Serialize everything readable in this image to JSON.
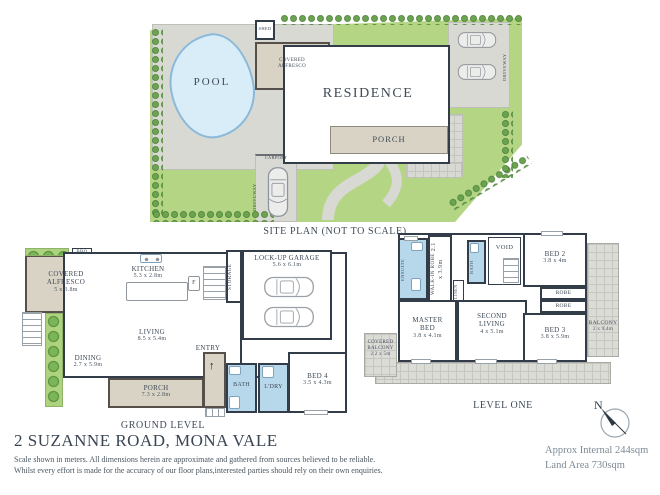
{
  "colors": {
    "wall": "#333d49",
    "wet_room_blue": "#b7d7ea",
    "outdoor_beige": "#d9d3c5",
    "grass_green": "#b3d584",
    "hedge_green": "#4e8538",
    "pool_water": "#d9edf9",
    "paving_grey": "#d9d9d4",
    "label_text": "#3e4a56",
    "footer_text": "#7d8a95"
  },
  "site_plan": {
    "caption": "SITE PLAN (NOT TO SCALE)",
    "labels": {
      "pool": "POOL",
      "shed": "SHED",
      "covered_alfresco": "COVERED ALFRESCO",
      "residence": "RESIDENCE",
      "porch": "PORCH",
      "carport": "CARPORT",
      "driveway_front": "DRIVEWAY",
      "driveway_side": "DRIVEWAY"
    }
  },
  "ground_level": {
    "caption": "GROUND LEVEL",
    "rooms": {
      "bbq": {
        "label": "BBQ"
      },
      "covered_alfresco": {
        "label": "COVERED ALFRESCO",
        "dims": "5 x 3.8m"
      },
      "kitchen": {
        "label": "KITCHEN",
        "dims": "5.3 x 2.8m"
      },
      "fridge": {
        "label": "F"
      },
      "living": {
        "label": "LIVING",
        "dims": "8.5 x 5.4m"
      },
      "dining": {
        "label": "DINING",
        "dims": "2.7 x 5.9m"
      },
      "storage": {
        "label": "STORAGE"
      },
      "garage": {
        "label": "LOCK-UP GARAGE",
        "dims": "5.6 x 6.1m"
      },
      "entry": {
        "label": "ENTRY"
      },
      "porch": {
        "label": "PORCH",
        "dims": "7.3 x 2.8m"
      },
      "bath": {
        "label": "BATH"
      },
      "laundry": {
        "label": "L'DRY"
      },
      "bed4": {
        "label": "BED 4",
        "dims": "3.5 x 4.3m"
      }
    }
  },
  "level_one": {
    "caption": "LEVEL ONE",
    "rooms": {
      "ensuite": {
        "label": "ENSUITE"
      },
      "walk_in_robe": {
        "label": "WALK-IN ROBE",
        "dims": "2.1 x 3.9m"
      },
      "bath": {
        "label": "BATH"
      },
      "linen": {
        "label": "LINEN"
      },
      "void": {
        "label": "VOID"
      },
      "master_bed": {
        "label": "MASTER BED",
        "dims": "3.8 x 4.1m"
      },
      "second_living": {
        "label": "SECOND LIVING",
        "dims": "4 x 5.1m"
      },
      "covered_balcony": {
        "label": "COVERED BALCONY",
        "dims": "2.2 x 5m"
      },
      "bed2": {
        "label": "BED 2",
        "dims": "3.8 x 4m"
      },
      "robe1": {
        "label": "ROBE"
      },
      "robe2": {
        "label": "ROBE"
      },
      "bed3": {
        "label": "BED 3",
        "dims": "3.8 x 5.9m"
      },
      "balcony": {
        "label": "BALCONY",
        "dims": "2 x 9.4m"
      }
    }
  },
  "footer": {
    "title": "2 SUZANNE ROAD, MONA VALE",
    "disclaimer_line1": "Scale shown in meters.  All dimensions herein are approximate and gathered from sources believed to be  reliable.",
    "disclaimer_line2": "Whilst every effort is made for the accuracy of our floor plans,interested parties should rely on their own enquiries.",
    "approx_internal": "Approx Internal 244sqm",
    "land_area": "Land Area 730sqm",
    "compass_north": "N"
  }
}
